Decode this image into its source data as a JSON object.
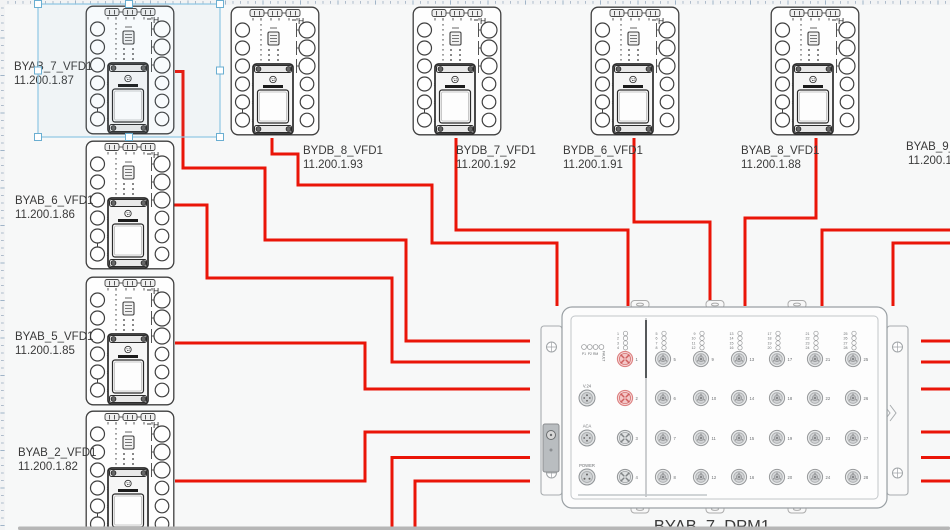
{
  "app": {
    "background": "#f7f8f8",
    "wire_color": "#ea1508",
    "selection_color": "#8ec7e4",
    "scrollbar_color": "#b6b6b6"
  },
  "vfd_glyph": "H",
  "vfd_pin_mark": "1",
  "devices": [
    {
      "name": "BYAB_7_VFD1",
      "ip": "11.200.1.87",
      "selected": true
    },
    {
      "name": "BYDB_8_VFD1",
      "ip": "11.200.1.93",
      "selected": false
    },
    {
      "name": "BYDB_7_VFD1",
      "ip": "11.200.1.92",
      "selected": false
    },
    {
      "name": "BYDB_6_VFD1",
      "ip": "11.200.1.91",
      "selected": false
    },
    {
      "name": "BYAB_8_VFD1",
      "ip": "11.200.1.88",
      "selected": false
    },
    {
      "name": "BYAB_9_",
      "ip": "11.200.1",
      "selected": false
    },
    {
      "name": "BYAB_6_VFD1",
      "ip": "11.200.1.86",
      "selected": false
    },
    {
      "name": "BYAB_5_VFD1",
      "ip": "11.200.1.85",
      "selected": false
    },
    {
      "name": "BYAB_2_VFD1",
      "ip": "11.200.1.82",
      "selected": false
    }
  ],
  "panel": {
    "label": "BYAB_7_DPM1",
    "status_leds": [
      "P1",
      "P2",
      "RM",
      "FAULT"
    ],
    "connector_labels": [
      "V.24",
      "ACA",
      "POWER"
    ],
    "left_ports": [
      {
        "number": 1,
        "highlighted": true
      },
      {
        "number": 2,
        "highlighted": true
      },
      {
        "number": 3,
        "highlighted": false
      },
      {
        "number": 4,
        "highlighted": false
      }
    ],
    "left_led_numbers": [
      1,
      2,
      3,
      4
    ],
    "right_ports": [
      5,
      6,
      7,
      8,
      9,
      10,
      11,
      12,
      13,
      14,
      15,
      16,
      17,
      18,
      19,
      20,
      21,
      22,
      23,
      24,
      25,
      26,
      27,
      28
    ],
    "port_colors": {
      "highlight_stroke": "#dd8181",
      "highlight_fill": "#f6d7d7",
      "normal_stroke": "#95989a",
      "normal_fill": "#e9ebec"
    }
  }
}
